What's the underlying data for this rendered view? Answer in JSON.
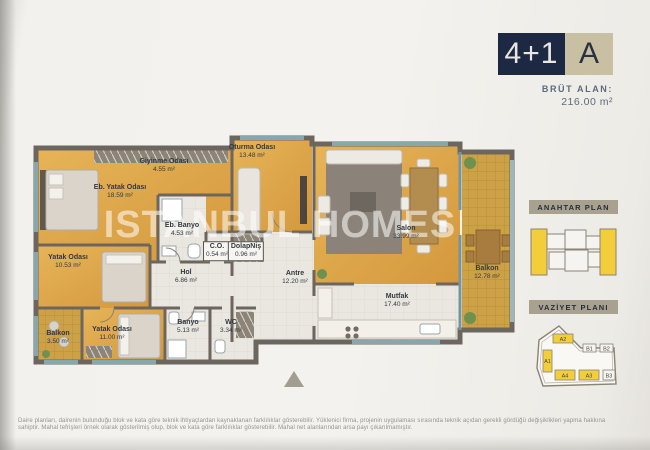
{
  "header": {
    "unit_type": "4+1",
    "block_letter": "A",
    "gross_area_label": "BRÜT ALAN:",
    "gross_area_value": "216.00 m²"
  },
  "watermark": "ISTANBUL HOMES",
  "panels": {
    "key_plan_title": "ANAHTAR PLAN",
    "site_plan_title": "VAZİYET PLANI"
  },
  "site_blocks": [
    {
      "label": "A2"
    },
    {
      "label": "B1"
    },
    {
      "label": "B2"
    },
    {
      "label": "A1"
    },
    {
      "label": "A4"
    },
    {
      "label": "A3"
    },
    {
      "label": "B3"
    }
  ],
  "rooms": [
    {
      "name": "Giyinme Odası",
      "area": "4.55 m²"
    },
    {
      "name": "Oturma Odası",
      "area": "13.48 m²"
    },
    {
      "name": "Eb. Yatak Odası",
      "area": "18.59 m²"
    },
    {
      "name": "Eb. Banyo",
      "area": "4.53 m²"
    },
    {
      "name": "C.O.",
      "area": "0.54 m²"
    },
    {
      "name": "DolapNiş",
      "area": "0.96 m²"
    },
    {
      "name": "Salon",
      "area": "33.99 m²"
    },
    {
      "name": "Balkon",
      "area": "12.78 m²"
    },
    {
      "name": "Yatak Odası",
      "area": "10.53 m²"
    },
    {
      "name": "Hol",
      "area": "6.86 m²"
    },
    {
      "name": "Antre",
      "area": "12.20 m²"
    },
    {
      "name": "Mutfak",
      "area": "17.40 m²"
    },
    {
      "name": "Balkon",
      "area": "3.50 m²"
    },
    {
      "name": "Yatak Odası",
      "area": "11.00 m²"
    },
    {
      "name": "Banyo",
      "area": "5.13 m²"
    },
    {
      "name": "WC",
      "area": "3.34 m²"
    }
  ],
  "colors": {
    "accent_navy": "#1d2942",
    "accent_beige": "#c9c0a4",
    "highlight_yellow": "#f2ce3a",
    "wood_floor": "#dca74a",
    "wall": "#6d665f"
  },
  "disclaimer": {
    "line1": "Daire planları, dairenin bulunduğu blok ve kata göre teknik ihtiyaçlardan kaynaklanan farklılıklar gösterebilir. Yüklenici firma, projenin uygulaması sırasında teknik açıdan gerekli gördüğü değişiklikleri yapma hakkına",
    "line2": "sahiptir. Mahal tefrişleri örnek olarak gösterilmiş olup, blok ve kata göre farklılıklar gösterebilir. Mahal net alanlarından arsa payı çıkarılmamıştır."
  }
}
